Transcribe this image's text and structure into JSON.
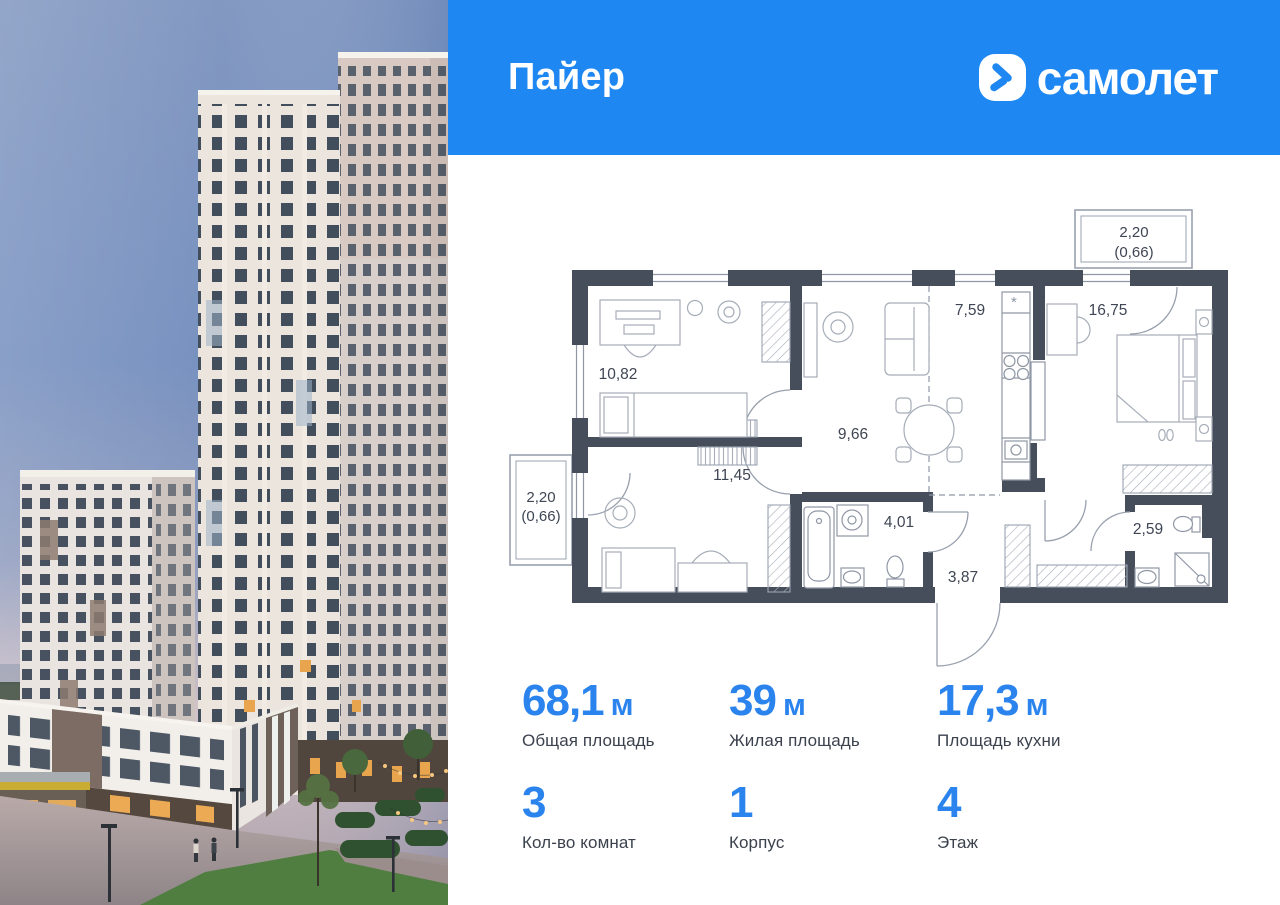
{
  "header": {
    "project_name": "Пайер",
    "brand": "самолет"
  },
  "plan": {
    "rooms": [
      {
        "name": "room-1",
        "area": "10,82"
      },
      {
        "name": "room-2",
        "area": "11,45"
      },
      {
        "name": "living-zone",
        "area": "9,66"
      },
      {
        "name": "kitchen-zone",
        "area": "7,59"
      },
      {
        "name": "bedroom",
        "area": "16,75"
      },
      {
        "name": "bathroom-1",
        "area": "4,01"
      },
      {
        "name": "hallway",
        "area": "3,87"
      },
      {
        "name": "bathroom-2",
        "area": "2,59"
      }
    ],
    "balconies": [
      {
        "name": "balcony-top",
        "width": "2,20",
        "area": "(0,66)"
      },
      {
        "name": "balcony-left",
        "width": "2,20",
        "area": "(0,66)"
      }
    ],
    "hood_symbol": "*"
  },
  "stats": {
    "areas": [
      {
        "value": "68,1",
        "unit": "м",
        "label": "Общая площадь"
      },
      {
        "value": "39",
        "unit": "м",
        "label": "Жилая площадь"
      },
      {
        "value": "17,3",
        "unit": "м",
        "label": "Площадь кухни"
      }
    ],
    "details": [
      {
        "value": "3",
        "label": "Кол-во комнат"
      },
      {
        "value": "1",
        "label": "Корпус"
      },
      {
        "value": "4",
        "label": "Этаж"
      }
    ]
  },
  "colors": {
    "header_blue": "#1e87f2",
    "accent_blue": "#2b84ed",
    "wall_dark": "#474e5b"
  }
}
